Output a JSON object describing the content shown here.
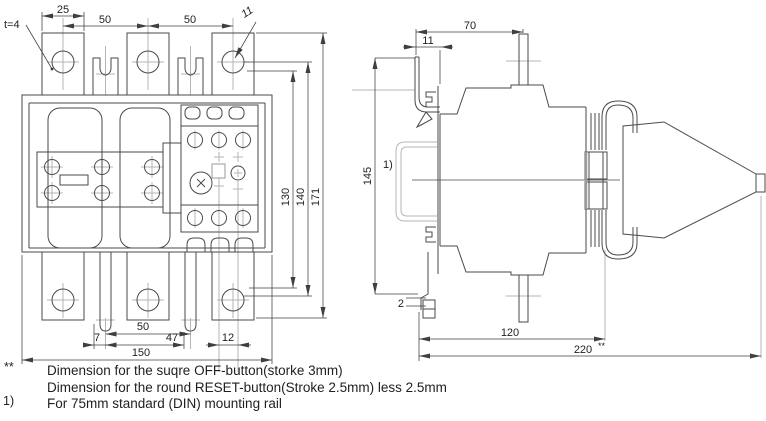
{
  "colors": {
    "background": "#ffffff",
    "line": "#4a4a4a",
    "light_line": "#b6b6b6",
    "text": "#1f1f1f"
  },
  "front_view": {
    "tab_width": "25",
    "pitch_left": "50",
    "pitch_right": "50",
    "thickness": "t=4",
    "hole_dia": "11",
    "inner_height": "130",
    "mid_height": "140",
    "total_height": "171",
    "edge_offset": "7",
    "slot_pitch": "50",
    "button_span": "47",
    "button_pitch": "12",
    "total_width": "150"
  },
  "side_view": {
    "depth_top": "70",
    "rail_offset": "11",
    "height": "145",
    "rail_ref": "1)",
    "clip_gap": "2",
    "depth_body": "120",
    "depth_total": "220",
    "depth_total_suffix": "**"
  },
  "footnotes": [
    {
      "marker": "**",
      "text": "Dimension for the suqre OFF-button(storke 3mm)"
    },
    {
      "marker": "",
      "text": "Dimension for the round RESET-button(Stroke 2.5mm) less 2.5mm"
    },
    {
      "marker": "1)",
      "text": "For 75mm standard (DIN) mounting rail"
    }
  ]
}
